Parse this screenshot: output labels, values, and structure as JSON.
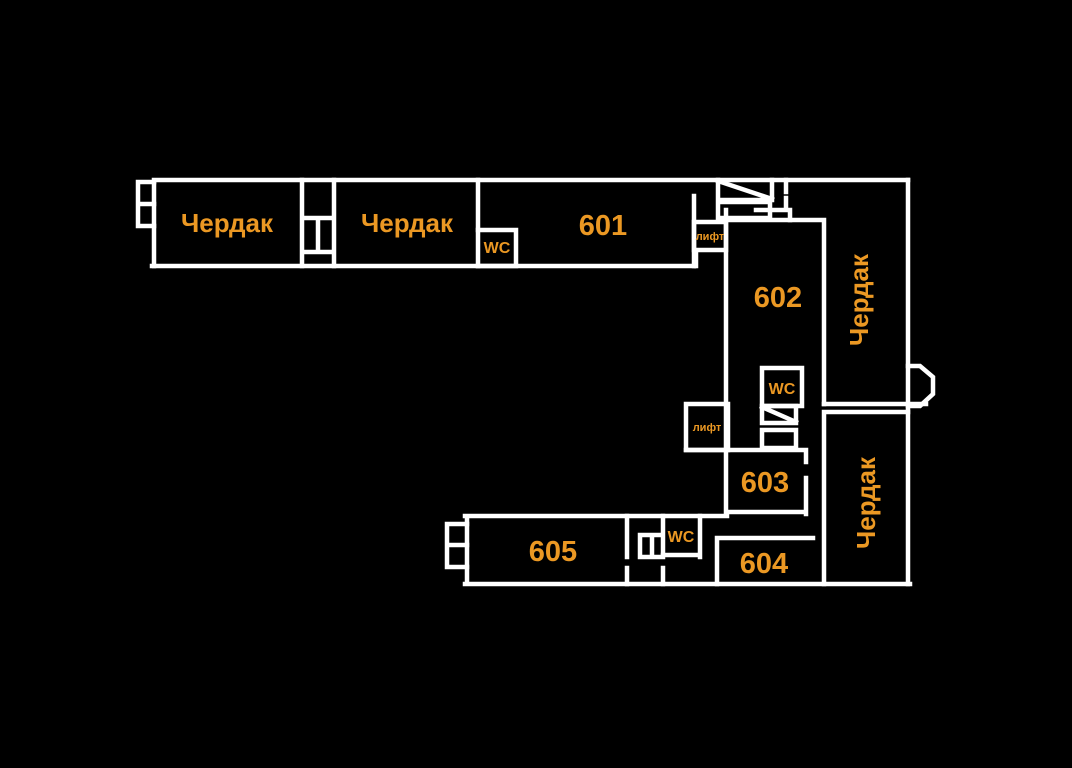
{
  "title": "Floor plan — attic level",
  "colors": {
    "background": "#000000",
    "walls": "#ffffff",
    "label": "#EB9823"
  },
  "rooms": {
    "attic_top_left": "Чердак",
    "attic_top_mid": "Чердак",
    "room_601": "601",
    "room_602": "602",
    "room_603": "603",
    "room_604": "604",
    "room_605": "605",
    "attic_right_upper": "Чердак",
    "attic_right_lower": "Чердак",
    "wc_top": "WC",
    "wc_mid": "WC",
    "wc_bottom": "WC",
    "lift_top": "лифт",
    "lift_mid": "лифт"
  }
}
